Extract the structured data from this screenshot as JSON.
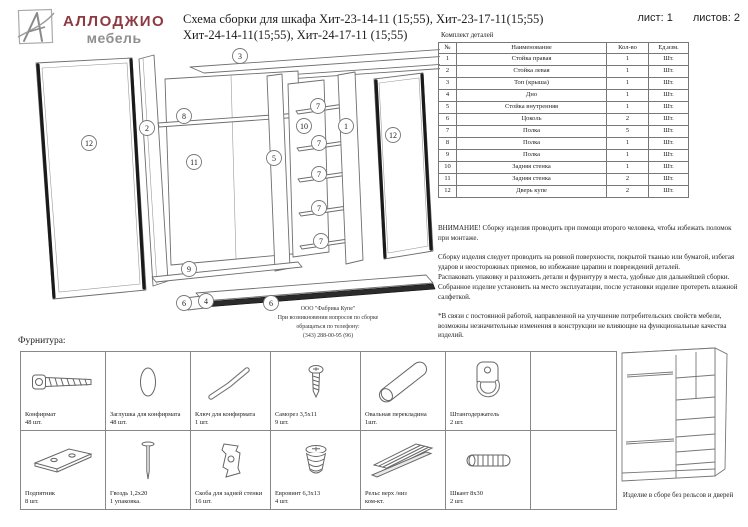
{
  "colors": {
    "brand_red": "#8d3a42",
    "brand_gray": "#8f8f8f",
    "line": "#6e6e6e",
    "text": "#1c1c1c"
  },
  "header": {
    "brand": "АЛЛОДЖИО",
    "brand_sub": "мебель",
    "title_line1": "Схема сборки для шкафа Хит-23-14-11 (15;55), Хит-23-17-11(15;55)",
    "title_line2": "Хит-24-14-11(15;55), Хит-24-17-11 (15;55)",
    "sheet_label": "лист: 1",
    "sheets_label": "листов: 2"
  },
  "parts_table": {
    "title": "Комплект деталей",
    "columns": [
      "№",
      "Наименование",
      "Кол-во",
      "Ед.изм."
    ],
    "rows": [
      {
        "num": "1",
        "name": "Стойка правая",
        "qty": "1",
        "unit": "Шт."
      },
      {
        "num": "2",
        "name": "Стойка левая",
        "qty": "1",
        "unit": "Шт."
      },
      {
        "num": "3",
        "name": "Топ (крыша)",
        "qty": "1",
        "unit": "Шт."
      },
      {
        "num": "4",
        "name": "Дно",
        "qty": "1",
        "unit": "Шт."
      },
      {
        "num": "5",
        "name": "Стойка внутренняя",
        "qty": "1",
        "unit": "Шт."
      },
      {
        "num": "6",
        "name": "Цоколь",
        "qty": "2",
        "unit": "Шт."
      },
      {
        "num": "7",
        "name": "Полка",
        "qty": "5",
        "unit": "Шт."
      },
      {
        "num": "8",
        "name": "Полка",
        "qty": "1",
        "unit": "Шт."
      },
      {
        "num": "9",
        "name": "Полка",
        "qty": "1",
        "unit": "Шт."
      },
      {
        "num": "10",
        "name": "Задняя стенка",
        "qty": "1",
        "unit": "Шт."
      },
      {
        "num": "11",
        "name": "Задняя стенка",
        "qty": "2",
        "unit": "Шт."
      },
      {
        "num": "12",
        "name": "Дверь купе",
        "qty": "2",
        "unit": "Шт."
      }
    ]
  },
  "notices": {
    "warning": "ВНИМАНИЕ! Сборку изделия проводить при помощи второго человека, чтобы избежать поломок при монтаже.",
    "assembly": "Сборку изделия следует проводить на ровной поверхности, покрытой тканью или бумагой, избегая ударов и неосторожных приемов, во избежание царапин и повреждений деталей.\nРаспаковать упаковку и разложить детали и фурнитуру в места, удобные для дальнейшей сборки.\nСобранное изделие установить на место эксплуатации, после установки изделие протереть влажной салфеткой.",
    "disclaimer": "*В связи с постоянной работой, направленной на улучшение потребительских свойств мебели, возможны незначительные изменения в конструкции не влияющие на функциональные качества изделий."
  },
  "contact": "ООО \"Фабрика Купе\"\nПри возникновении вопросов по сборке\nобращаться по телефону:\n(343) 288-00-95 (96)",
  "diagram": {
    "callouts": [
      {
        "n": "3",
        "x": 230,
        "y": 16
      },
      {
        "n": "12",
        "x": 79,
        "y": 103
      },
      {
        "n": "2",
        "x": 137,
        "y": 88
      },
      {
        "n": "8",
        "x": 174,
        "y": 76
      },
      {
        "n": "11",
        "x": 184,
        "y": 122
      },
      {
        "n": "9",
        "x": 179,
        "y": 229
      },
      {
        "n": "5",
        "x": 264,
        "y": 118
      },
      {
        "n": "10",
        "x": 294,
        "y": 86
      },
      {
        "n": "7",
        "x": 308,
        "y": 66
      },
      {
        "n": "7",
        "x": 309,
        "y": 103
      },
      {
        "n": "7",
        "x": 309,
        "y": 134
      },
      {
        "n": "7",
        "x": 309,
        "y": 168
      },
      {
        "n": "7",
        "x": 311,
        "y": 201
      },
      {
        "n": "1",
        "x": 336,
        "y": 86
      },
      {
        "n": "12",
        "x": 383,
        "y": 95
      },
      {
        "n": "6",
        "x": 174,
        "y": 263
      },
      {
        "n": "4",
        "x": 196,
        "y": 261
      },
      {
        "n": "6",
        "x": 261,
        "y": 263
      }
    ]
  },
  "hardware": {
    "title": "Фурнитура:",
    "items": [
      {
        "icon": "confirmat-screw-icon",
        "name": "Конфирмат",
        "qty": "48 шт."
      },
      {
        "icon": "confirmat-cap-icon",
        "name": "Заглушка для конфирмата",
        "qty": "48 шт."
      },
      {
        "icon": "hex-key-icon",
        "name": "Ключ для конфирмата",
        "qty": "1 шт."
      },
      {
        "icon": "small-screw-icon",
        "name": "Саморез 3,5х11",
        "qty": "9 шт."
      },
      {
        "icon": "oval-tube-icon",
        "name": "Овальная перекладина",
        "qty": "1шт."
      },
      {
        "icon": "rod-holder-icon",
        "name": "Штангодержатель",
        "qty": "2 шт."
      },
      {
        "icon": "",
        "name": "",
        "qty": ""
      },
      {
        "icon": "foot-pad-icon",
        "name": "Подпятник",
        "qty": "8 шт."
      },
      {
        "icon": "nail-icon",
        "name": "Гвоздь 1,2х20",
        "qty": "1 упаковка."
      },
      {
        "icon": "back-panel-clip-icon",
        "name": "Скоба для задней стенки",
        "qty": "16 шт."
      },
      {
        "icon": "euro-screw-icon",
        "name": "Евровинт 6,3х13",
        "qty": "4 шт."
      },
      {
        "icon": "rail-icon",
        "name": "Рельс верх /низ",
        "qty": "ком-кт."
      },
      {
        "icon": "dowel-icon",
        "name": "Шкант 8х30",
        "qty": "2 шт."
      },
      {
        "icon": "",
        "name": "",
        "qty": ""
      }
    ]
  },
  "assembled": {
    "caption": "Изделие в сборе без рельсов и дверей"
  }
}
